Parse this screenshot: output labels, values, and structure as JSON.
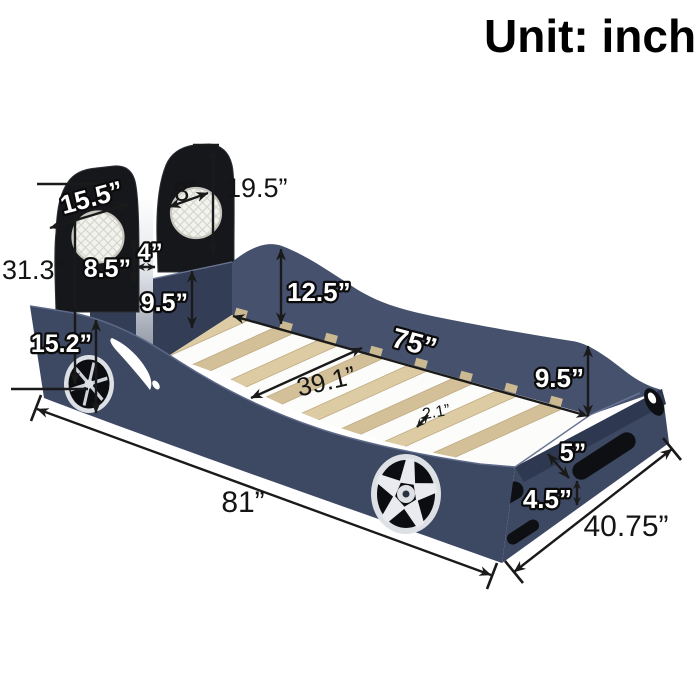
{
  "title": "Unit: inch",
  "labels": {
    "overall_height": "31.3”",
    "headrest_width": "15.5”",
    "headrest_pad": "8”",
    "headrest_height": "19.5”",
    "headrest_gap_height": "8.5”",
    "headrest_gap_width": "4”",
    "headboard_to_slat": "9.5”",
    "side_rail_height": "12.5”",
    "front_panel_height": "15.2”",
    "inner_length": "75”",
    "inner_width": "39.1”",
    "slat_thickness": "2.1”",
    "foot_rail_height": "9.5”",
    "foot_inner_height": "5”",
    "foot_base_height": "4.5”",
    "overall_length": "81”",
    "overall_width": "40.75”"
  },
  "colors": {
    "body": "#3d4862",
    "bodyDark": "#333d55",
    "bodyDeep": "#2e3850",
    "bodyLight": "#46516e",
    "seat": "#15171b",
    "slat": "#ddcba4",
    "slat2": "#d4c098",
    "slatDark": "#cbb992",
    "wheelRim": "#dde1e6",
    "line": "#1a1a1a"
  }
}
